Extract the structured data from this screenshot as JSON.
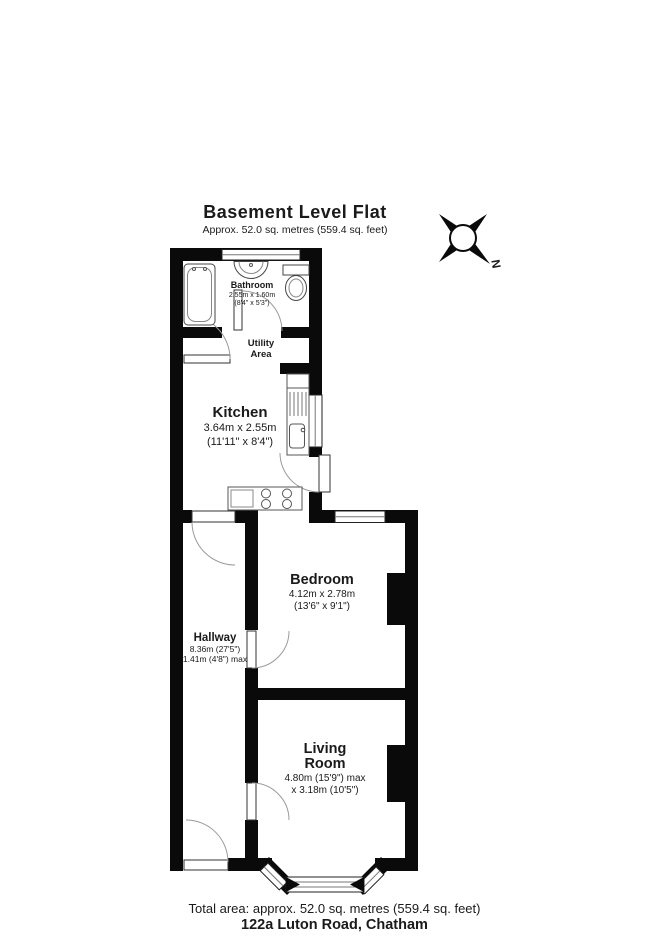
{
  "header": {
    "title": "Basement Level Flat",
    "subtitle": "Approx. 52.0 sq. metres (559.4 sq. feet)"
  },
  "compass": {
    "north_label": "N"
  },
  "rooms": {
    "bathroom": {
      "name": "Bathroom",
      "dims1": "2.55m x 1.60m",
      "dims2": "(8'4\" x 5'3\")"
    },
    "utility": {
      "name1": "Utility",
      "name2": "Area"
    },
    "kitchen": {
      "name": "Kitchen",
      "dims1": "3.64m x 2.55m",
      "dims2": "(11'11\" x 8'4\")"
    },
    "bedroom": {
      "name": "Bedroom",
      "dims1": "4.12m x 2.78m",
      "dims2": "(13'6\" x 9'1\")"
    },
    "hallway": {
      "name": "Hallway",
      "dims1": "8.36m (27'5\")",
      "dims2": "1.41m (4'8\") max"
    },
    "living": {
      "name1": "Living",
      "name2": "Room",
      "dims1": "4.80m (15'9\") max",
      "dims2": "x 3.18m (10'5\")"
    }
  },
  "footer": {
    "total_area": "Total area: approx. 52.0 sq. metres (559.4 sq. feet)",
    "address": "122a Luton Road, Chatham"
  },
  "colors": {
    "wall": "#0a0a0a",
    "fixture_stroke": "#444444",
    "arc_stroke": "#9a9a9a"
  }
}
